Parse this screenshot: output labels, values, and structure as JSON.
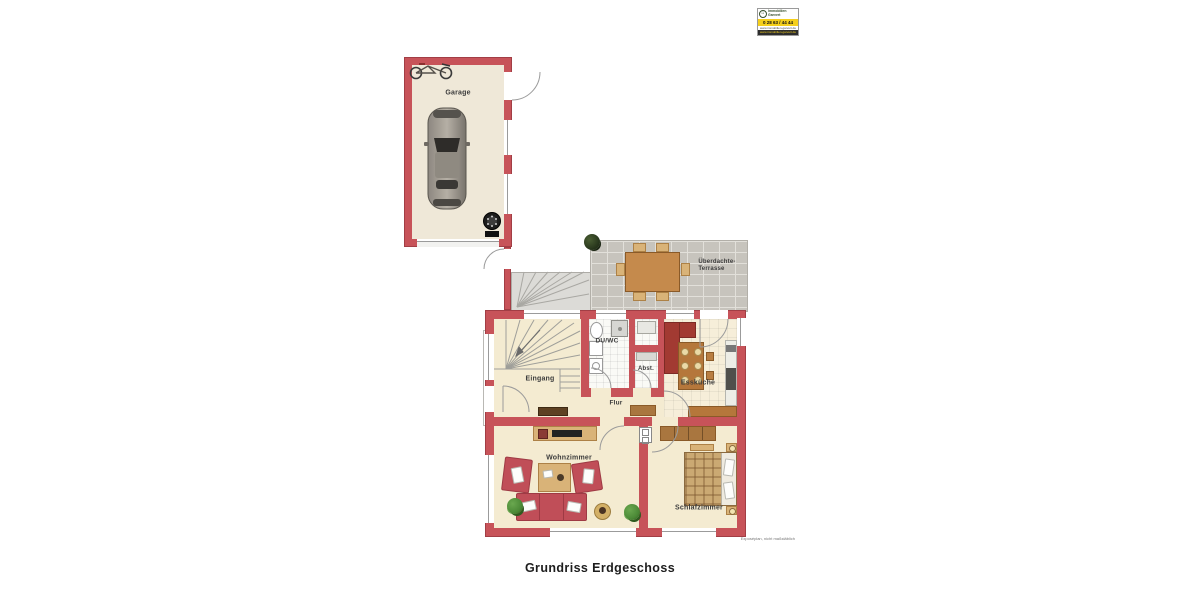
{
  "footer": {
    "title": "Grundriss Erdgeschoss",
    "disclaimer": "Exposéplan, nicht maßstäblich"
  },
  "logo": {
    "company_line1": "Immobilien",
    "company_line2": "Garvert",
    "phone": "0 28 63 / 44 44",
    "web": "www.immobilien-garvert.de",
    "house_glyph": "⌂"
  },
  "rooms": {
    "garage": "Garage",
    "eingang": "Eingang",
    "du_wc": "DU/WC",
    "abst": "Abst.",
    "flur": "Flur",
    "esskueche": "Essküche",
    "wohnzimmer": "Wohnzimmer",
    "schlafzimmer": "Schlafzimmer",
    "terrasse_line1": "Überdachte-",
    "terrasse_line2": "Terrasse"
  },
  "icons": {
    "car": "car-top-view",
    "bicycle": "bicycle",
    "tires": "tire-stack",
    "entrance_arrow": "entrance-arrow",
    "stairs": "winder-stairs",
    "door_swings": "door-swing-arcs"
  },
  "colors": {
    "wall": "#C75359",
    "wallEdge": "#A23E45",
    "floor": "#F4EBD1",
    "floorTile": "#F6EED9",
    "bath": "#FAFAF6",
    "terrace": "#C7C4BD",
    "terraceLine": "#E2E0DA",
    "stair": "#DCDBD7",
    "wood": "#B97E42",
    "woodDark": "#8A5A28",
    "woodLight": "#D9B378",
    "sofa": "#C04E58",
    "sofaDark": "#9E3A44",
    "kitchenUnit": "#A23A32",
    "counter": "#EDEDE6",
    "green": "#4C8A37",
    "greenDark": "#2F5B1F",
    "line": "#9B9B9B",
    "text": "#3C3C3C",
    "yellow": "#F5CF1B"
  }
}
